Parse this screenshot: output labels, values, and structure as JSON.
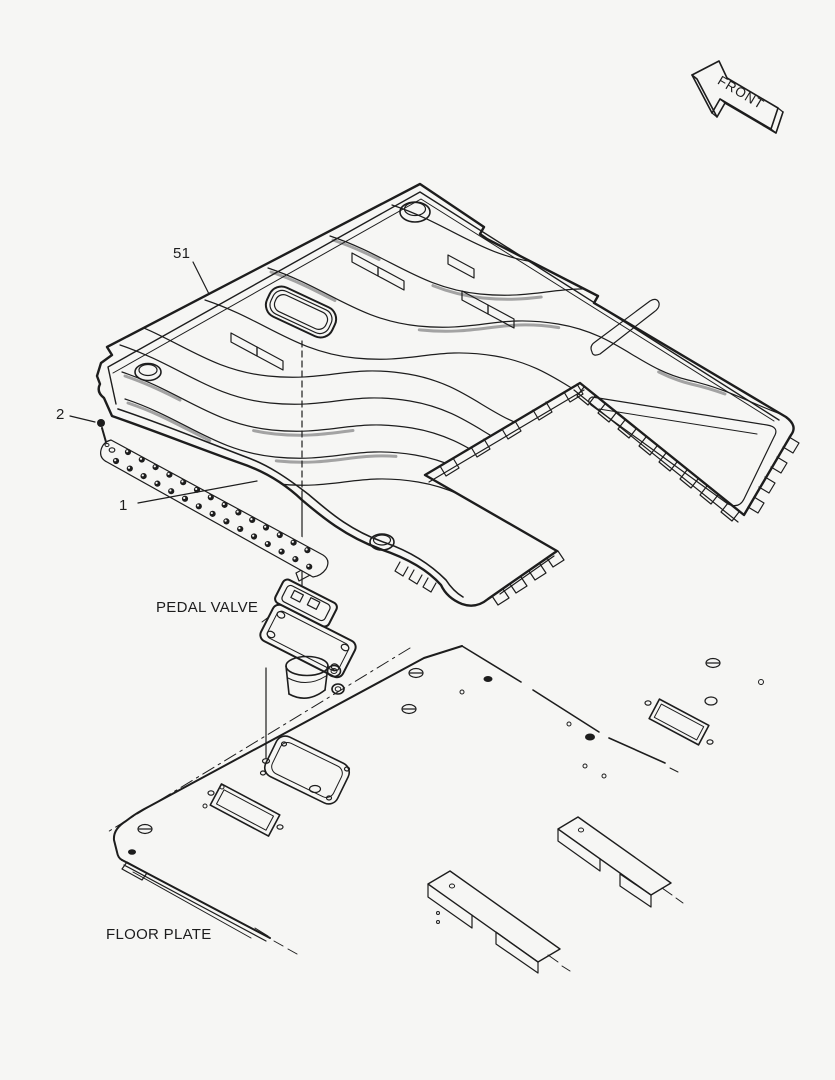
{
  "page": {
    "background": "#f6f6f4",
    "line_color": "#1d1d1d",
    "shade_color": "#9a9a9a"
  },
  "diagram": {
    "type": "exploded-parts-diagram",
    "callouts": {
      "mat": "51",
      "mount_screw": "2",
      "tread_strip": "1"
    },
    "captions": {
      "pedal_valve": "PEDAL VALVE",
      "floor_plate": "FLOOR PLATE"
    },
    "direction_arrow": {
      "label": "FRONT",
      "icon": "front-direction-arrow-icon"
    }
  }
}
